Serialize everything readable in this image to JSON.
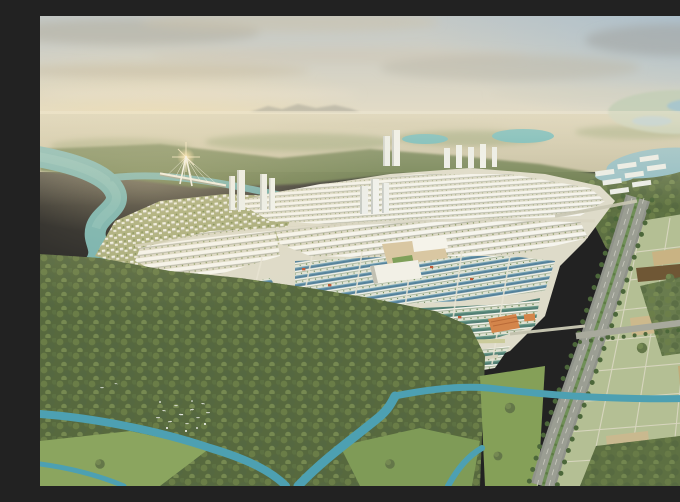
{
  "scene": {
    "type": "aerial-masterplan-render",
    "elements": [
      "sky",
      "clouds",
      "distant-city-haze",
      "mountains",
      "wetland",
      "lakes",
      "river",
      "cable-stayed-bridge",
      "sun-glint",
      "high-rise-towers",
      "white-rowhouse-district",
      "villa-peninsula",
      "teal-rowhouse-district",
      "red-roof-villas",
      "civic-complex",
      "orange-buildings",
      "tree-lined-boulevard",
      "cross-road",
      "land-parcel-grid",
      "tilled-field",
      "mangrove-forest",
      "egret-flock",
      "canals",
      "grass-clearings"
    ]
  },
  "palette": {
    "sky_top": "#c3c8c6",
    "sky_mid": "#d9d5c5",
    "sky_horizon": "#ece2c8",
    "sky_blue": "#9db9cf",
    "cloud_grey": "#b3aea1",
    "cloud_dark": "#a3a5a3",
    "cloud_warm": "#cec3ab",
    "land_far": "#d5ccae",
    "land_near": "#c4bd9e",
    "mountain": "#b3b0a1",
    "distant_green": "#99a376",
    "water_river": "#74b2b0",
    "water_canal": "#4da0b2",
    "water_lake": "#8fbcc4",
    "water_pond": "#5fb3b5",
    "wetland_blue": "#a9c6cc",
    "forest_base": "#57693e",
    "forest_band": "#6b7b4c",
    "grass_light": "#8ba55f",
    "grass_mid": "#7f9b57",
    "ground_dev": "#dedbc9",
    "house_white": "#f6f5ee",
    "house_shadow": "#b2b4a6",
    "roof_teal": "#527f74",
    "roof_teal_blue": "#55829b",
    "roof_red": "#bf5a38",
    "villa_base": "#a9ad7c",
    "plaza_tan": "#d9c7a2",
    "civic_white": "#f2f0e6",
    "lawn_green": "#7fa05a",
    "orange_bldg": "#d4854b",
    "tower_white": "#eef0ec",
    "tower_shade": "#c7cbc6",
    "road_main": "#90938a",
    "road_pale": "#c9c6b2",
    "road_yellow": "#cbcb9b",
    "median_green": "#6f8f57",
    "road_tree": "#4c673a",
    "field_green": "#b4bf94",
    "field_tan": "#c9b383",
    "field_brown": "#6f5735",
    "grid_line": "#dbd8c3",
    "bird_white": "#ffffff",
    "glint_gold": "#ffe2a0",
    "bridge_white": "#f8f6ee"
  }
}
